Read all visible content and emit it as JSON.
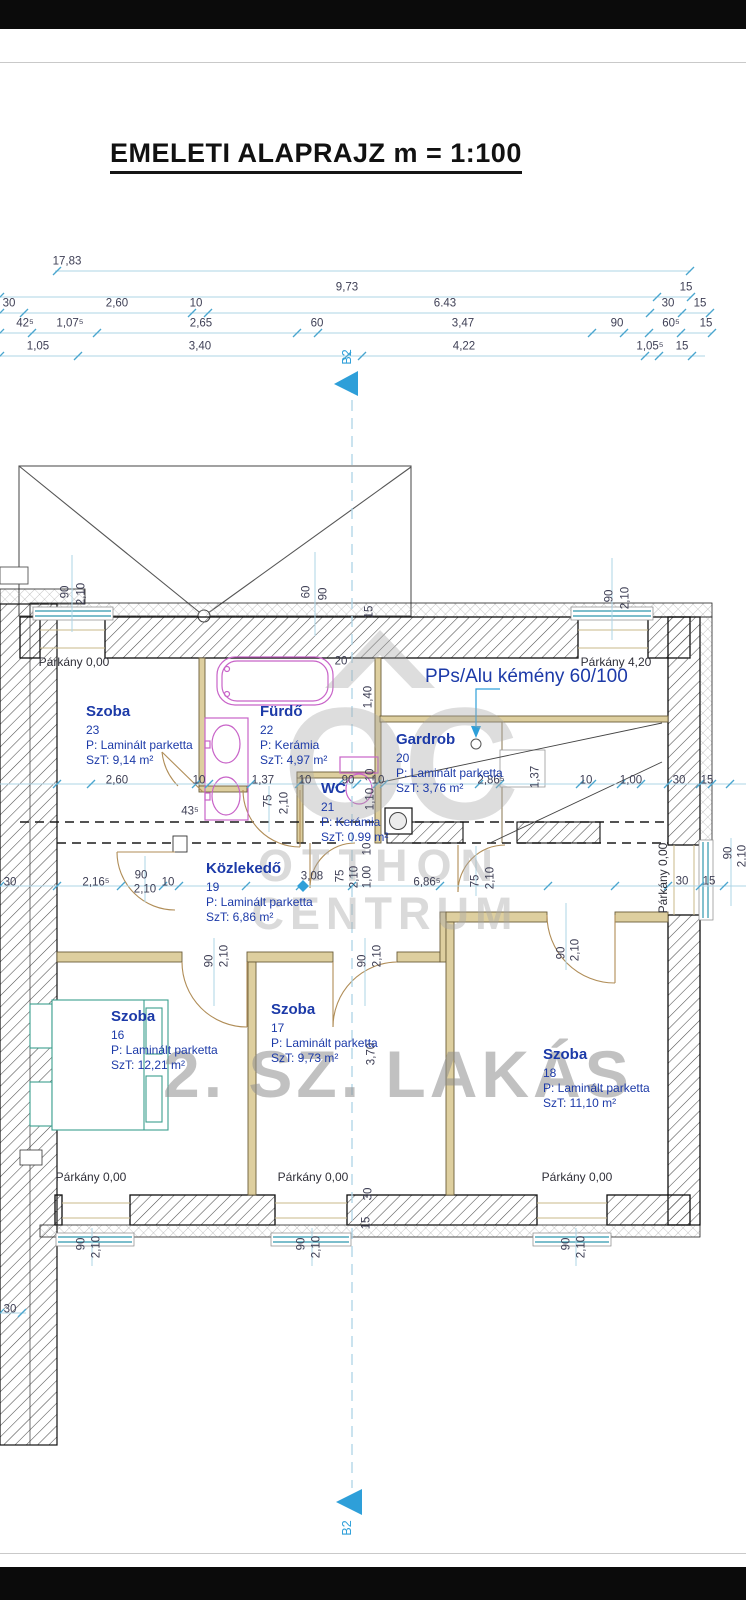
{
  "title": "EMELETI ALAPRAJZ m = 1:100",
  "chimney_label": "PPs/Alu kémény 60/100",
  "watermark": {
    "logo": "OC",
    "line1": "OTTHON",
    "line2": "CENTRUM",
    "unit": "2. SZ. LAKÁS"
  },
  "colors": {
    "accent_cyan": "#2e9fd9",
    "dim_line": "#aed4e6",
    "room_navy": "#1c3aa8",
    "fixture_magenta": "#c863c8",
    "furniture_teal": "#3b9e8e",
    "wall_tan": "#decf9f",
    "watermark_gray": "#a8a8a8"
  },
  "top_dimension_rows": [
    {
      "y": 271,
      "labels": [
        {
          "t": "17,83",
          "x": 67
        }
      ]
    },
    {
      "y": 297,
      "labels": [
        {
          "t": "9,73",
          "x": 347
        },
        {
          "t": "15",
          "x": 686
        }
      ]
    },
    {
      "y": 313,
      "labels": [
        {
          "t": "30",
          "x": 9
        },
        {
          "t": "2,60",
          "x": 117
        },
        {
          "t": "10",
          "x": 196
        },
        {
          "t": "6.43",
          "x": 445
        },
        {
          "t": "30",
          "x": 668
        },
        {
          "t": "15",
          "x": 700
        }
      ]
    },
    {
      "y": 333,
      "labels": [
        {
          "t": "42⁵",
          "x": 25
        },
        {
          "t": "1,07⁵",
          "x": 70
        },
        {
          "t": "2,65",
          "x": 201
        },
        {
          "t": "60",
          "x": 317
        },
        {
          "t": "3,47",
          "x": 463
        },
        {
          "t": "90",
          "x": 617
        },
        {
          "t": "60⁵",
          "x": 671
        },
        {
          "t": "15",
          "x": 706
        }
      ]
    },
    {
      "y": 356,
      "labels": [
        {
          "t": "1,05",
          "x": 38
        },
        {
          "t": "3,40",
          "x": 200
        },
        {
          "t": "4,22",
          "x": 464
        },
        {
          "t": "1,05⁵",
          "x": 650
        },
        {
          "t": "15",
          "x": 682
        }
      ]
    }
  ],
  "rooms": [
    {
      "name": "Szoba",
      "number": "23",
      "floor": "P: Laminált parketta",
      "area": "SzT: 9,14 m²",
      "x": 86,
      "y": 703
    },
    {
      "name": "Fürdő",
      "number": "22",
      "floor": "P: Kerámia",
      "area": "SzT: 4,97 m²",
      "x": 260,
      "y": 703
    },
    {
      "name": "WC",
      "number": "21",
      "floor": "P: Kerámia",
      "area": "SzT: 0.99 m²",
      "x": 321,
      "y": 780
    },
    {
      "name": "Gardrob",
      "number": "20",
      "floor": "P: Laminált parketta",
      "area": "SzT: 3,76 m²",
      "x": 396,
      "y": 731
    },
    {
      "name": "Közlekedő",
      "number": "19",
      "floor": "P: Laminált parketta",
      "area": "SzT: 6,86 m²",
      "x": 206,
      "y": 860
    },
    {
      "name": "Szoba",
      "number": "16",
      "floor": "P: Laminált parketta",
      "area": "SzT: 12,21 m²",
      "x": 111,
      "y": 1008
    },
    {
      "name": "Szoba",
      "number": "17",
      "floor": "P: Laminált parketta",
      "area": "SzT: 9,73 m²",
      "x": 271,
      "y": 1001
    },
    {
      "name": "Szoba",
      "number": "18",
      "floor": "P: Laminált parketta",
      "area": "SzT: 11,10 m²",
      "x": 543,
      "y": 1046
    }
  ],
  "plan_labels": [
    {
      "t": "Párkány 0,00",
      "x": 74,
      "y": 662,
      "cls": "pk"
    },
    {
      "t": "Párkány 4,20",
      "x": 616,
      "y": 662,
      "cls": "pk"
    },
    {
      "t": "20",
      "x": 341,
      "y": 662
    },
    {
      "t": "43⁵",
      "x": 190,
      "y": 812
    },
    {
      "t": "2,60",
      "x": 117,
      "y": 781
    },
    {
      "t": "10",
      "x": 199,
      "y": 781
    },
    {
      "t": "1,37",
      "x": 263,
      "y": 781
    },
    {
      "t": "10",
      "x": 305,
      "y": 781
    },
    {
      "t": "90",
      "x": 348,
      "y": 781
    },
    {
      "t": "10",
      "x": 378,
      "y": 781
    },
    {
      "t": "2,86⁵",
      "x": 491,
      "y": 781
    },
    {
      "t": "10",
      "x": 586,
      "y": 781
    },
    {
      "t": "1,00",
      "x": 631,
      "y": 781
    },
    {
      "t": "30",
      "x": 679,
      "y": 781
    },
    {
      "t": "15",
      "x": 707,
      "y": 781
    },
    {
      "t": "30",
      "x": 10,
      "y": 883
    },
    {
      "t": "2,16⁵",
      "x": 96,
      "y": 883
    },
    {
      "t": "10",
      "x": 168,
      "y": 883
    },
    {
      "t": "3,08",
      "x": 312,
      "y": 877
    },
    {
      "t": "6,86⁵",
      "x": 427,
      "y": 883
    },
    {
      "t": "90",
      "x": 141,
      "y": 876
    },
    {
      "t": "2,10",
      "x": 145,
      "y": 890
    },
    {
      "t": "30",
      "x": 682,
      "y": 882
    },
    {
      "t": "15",
      "x": 709,
      "y": 882
    },
    {
      "t": "30",
      "x": 10,
      "y": 1310
    },
    {
      "t": "Párkány 0,00",
      "x": 91,
      "y": 1177,
      "cls": "pk"
    },
    {
      "t": "Párkány 0,00",
      "x": 313,
      "y": 1177,
      "cls": "pk"
    },
    {
      "t": "Párkány 0,00",
      "x": 577,
      "y": 1177,
      "cls": "pk"
    },
    {
      "t": "90",
      "x": 66,
      "y": 592,
      "r": 1
    },
    {
      "t": "2,10",
      "x": 82,
      "y": 594,
      "r": 1
    },
    {
      "t": "60",
      "x": 307,
      "y": 592,
      "r": 1
    },
    {
      "t": "90",
      "x": 324,
      "y": 594,
      "r": 1
    },
    {
      "t": "90",
      "x": 610,
      "y": 596,
      "r": 1
    },
    {
      "t": "2,10",
      "x": 626,
      "y": 598,
      "r": 1
    },
    {
      "t": "15",
      "x": 370,
      "y": 612,
      "r": 1
    },
    {
      "t": "1,40",
      "x": 369,
      "y": 697,
      "r": 1
    },
    {
      "t": "10",
      "x": 371,
      "y": 775,
      "r": 1
    },
    {
      "t": "1,10",
      "x": 371,
      "y": 799,
      "r": 1
    },
    {
      "t": "75",
      "x": 269,
      "y": 801,
      "r": 1
    },
    {
      "t": "2,10",
      "x": 285,
      "y": 803,
      "r": 1
    },
    {
      "t": "1,37",
      "x": 536,
      "y": 777,
      "r": 1
    },
    {
      "t": "10",
      "x": 368,
      "y": 849,
      "r": 1
    },
    {
      "t": "75",
      "x": 341,
      "y": 876,
      "r": 1
    },
    {
      "t": "2,10",
      "x": 355,
      "y": 877,
      "r": 1
    },
    {
      "t": "1,00",
      "x": 368,
      "y": 877,
      "r": 1
    },
    {
      "t": "75",
      "x": 476,
      "y": 881,
      "r": 1
    },
    {
      "t": "2,10",
      "x": 491,
      "y": 878,
      "r": 1
    },
    {
      "t": "90",
      "x": 210,
      "y": 961,
      "r": 1
    },
    {
      "t": "2,10",
      "x": 225,
      "y": 956,
      "r": 1
    },
    {
      "t": "90",
      "x": 363,
      "y": 961,
      "r": 1
    },
    {
      "t": "2,10",
      "x": 378,
      "y": 956,
      "r": 1
    },
    {
      "t": "90",
      "x": 562,
      "y": 953,
      "r": 1
    },
    {
      "t": "2,10",
      "x": 576,
      "y": 950,
      "r": 1
    },
    {
      "t": "3,70",
      "x": 372,
      "y": 1054,
      "r": 1
    },
    {
      "t": "30",
      "x": 369,
      "y": 1194,
      "r": 1
    },
    {
      "t": "15",
      "x": 367,
      "y": 1223,
      "r": 1
    },
    {
      "t": "90",
      "x": 82,
      "y": 1244,
      "r": 1
    },
    {
      "t": "2,10",
      "x": 97,
      "y": 1247,
      "r": 1
    },
    {
      "t": "90",
      "x": 302,
      "y": 1244,
      "r": 1
    },
    {
      "t": "2,10",
      "x": 317,
      "y": 1247,
      "r": 1
    },
    {
      "t": "90",
      "x": 567,
      "y": 1244,
      "r": 1
    },
    {
      "t": "2,10",
      "x": 582,
      "y": 1247,
      "r": 1
    },
    {
      "t": "90",
      "x": 729,
      "y": 853,
      "r": 1
    },
    {
      "t": "2,10",
      "x": 743,
      "y": 856,
      "r": 1
    },
    {
      "t": "Párkány 0,00",
      "x": 663,
      "y": 878,
      "r": 1,
      "cls": "pk"
    },
    {
      "t": "B2",
      "x": 347,
      "y": 357,
      "r": 1,
      "cls": "cyan"
    },
    {
      "t": "B2",
      "x": 347,
      "y": 1528,
      "r": 1,
      "cls": "cyan"
    }
  ]
}
